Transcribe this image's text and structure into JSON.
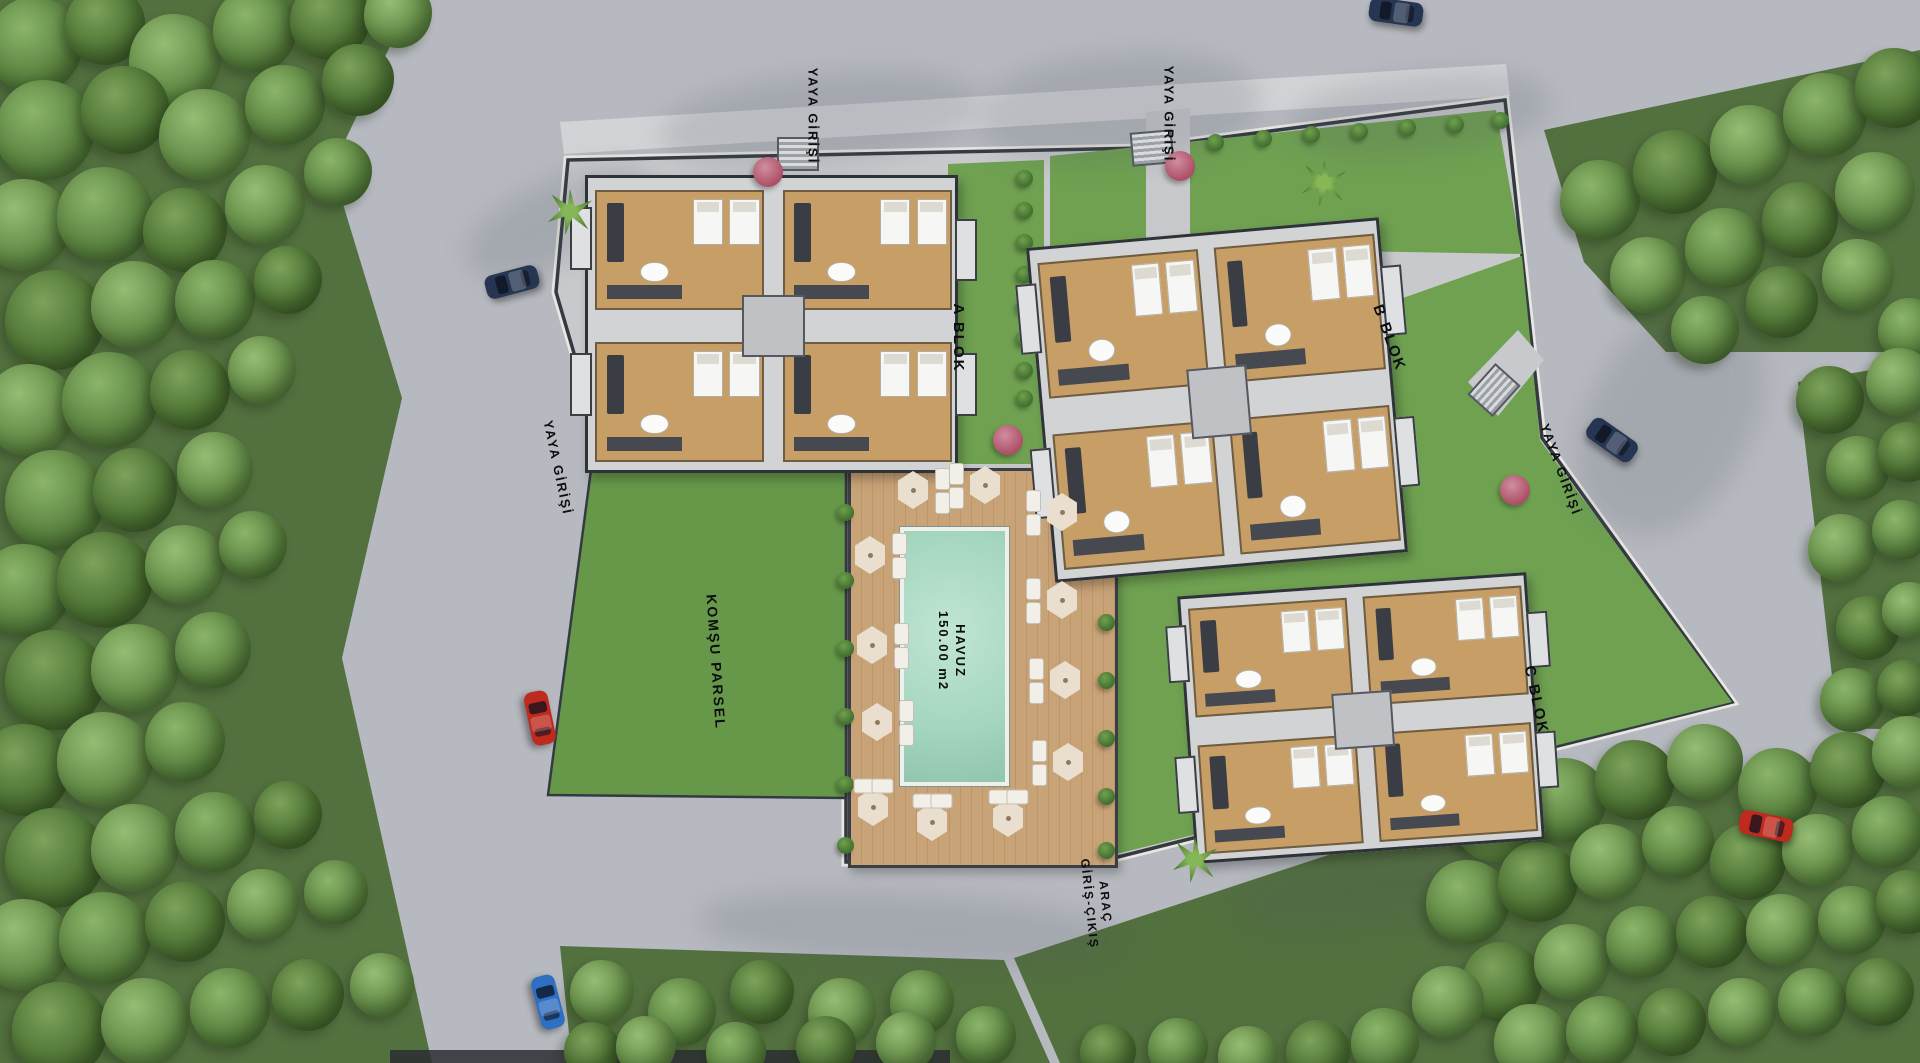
{
  "scene": {
    "width": 1920,
    "height": 1063,
    "type": "residential-site-plan"
  },
  "colors": {
    "road": "#b6b9bf",
    "sidewalk": "#d2d3d6",
    "forest": "#53703f",
    "lawn": "#6fa151",
    "lawn2": "#67984a",
    "paving": "#c8c9cc",
    "boundary": "#343a41",
    "curb": "#e9e7e1",
    "deck": "#c8a377",
    "pool": "#a5d6c0",
    "plate": "#d2d3d5",
    "bborder": "#2e3338",
    "floor": "#c79e66",
    "dark": "#3a3e44",
    "umbrella": "#eadfce",
    "bush": "#3f6b2e",
    "navy": "#263652",
    "red": "#bf2a1e",
    "blue": "#2f6fc2"
  },
  "labels": [
    {
      "id": "yaya-girisi-top-left",
      "text": "YAYA GİRİŞİ",
      "x": 812,
      "y": 116,
      "rot": 90,
      "size": 13
    },
    {
      "id": "yaya-girisi-top-right",
      "text": "YAYA GİRİŞİ",
      "x": 1168,
      "y": 114,
      "rot": 90,
      "size": 13
    },
    {
      "id": "yaya-girisi-west",
      "text": "YAYA GİRİŞİ",
      "x": 557,
      "y": 468,
      "rot": 78,
      "size": 13
    },
    {
      "id": "yaya-girisi-east",
      "text": "YAYA GİRİŞİ",
      "x": 1560,
      "y": 470,
      "rot": 70,
      "size": 13
    },
    {
      "id": "arac-giris-cikis",
      "text": "ARAÇ\nGİRİŞ-ÇIKIŞ",
      "x": 1097,
      "y": 903,
      "rot": 84,
      "size": 12
    },
    {
      "id": "a-blok-label",
      "text": "A BLOK",
      "x": 958,
      "y": 338,
      "rot": 90,
      "size": 15
    },
    {
      "id": "b-blok-label",
      "text": "B BLOK",
      "x": 1389,
      "y": 338,
      "rot": 70,
      "size": 15
    },
    {
      "id": "c-blok-label",
      "text": "C BLOK",
      "x": 1536,
      "y": 700,
      "rot": 78,
      "size": 15
    },
    {
      "id": "komsu-parsel-label",
      "text": "KOMŞU PARSEL",
      "x": 716,
      "y": 662,
      "rot": 86,
      "size": 14
    },
    {
      "id": "havuz-label",
      "text": "HAVUZ\n150.00 m2",
      "x": 951,
      "y": 651,
      "rot": 90,
      "size": 13
    }
  ],
  "buildings": [
    {
      "id": "a-blok",
      "x": 585,
      "y": 175,
      "w": 367,
      "h": 292,
      "rot": 0
    },
    {
      "id": "b-blok",
      "x": 1040,
      "y": 232,
      "w": 348,
      "h": 330,
      "rot": -5
    },
    {
      "id": "c-blok",
      "x": 1186,
      "y": 584,
      "w": 344,
      "h": 262,
      "rot": -4
    }
  ],
  "stairs": [
    {
      "x": 796,
      "y": 152,
      "rot": 0
    },
    {
      "x": 1150,
      "y": 146,
      "rot": -5
    },
    {
      "x": 1492,
      "y": 388,
      "rot": -48
    }
  ],
  "cars": [
    {
      "color": "navy",
      "x": 512,
      "y": 282,
      "rot": -15
    },
    {
      "color": "red",
      "x": 540,
      "y": 718,
      "rot": 78
    },
    {
      "color": "blue",
      "x": 548,
      "y": 1002,
      "rot": 75
    },
    {
      "color": "navy",
      "x": 1396,
      "y": 12,
      "rot": 8
    },
    {
      "color": "navy",
      "x": 1612,
      "y": 440,
      "rot": 35
    },
    {
      "color": "red",
      "x": 1766,
      "y": 826,
      "rot": 12
    }
  ],
  "umbrellas": [
    [
      913,
      490
    ],
    [
      985,
      485
    ],
    [
      1062,
      512
    ],
    [
      870,
      555
    ],
    [
      1062,
      600
    ],
    [
      872,
      645
    ],
    [
      1065,
      680
    ],
    [
      877,
      722
    ],
    [
      1068,
      762
    ],
    [
      873,
      807
    ],
    [
      932,
      822
    ],
    [
      1008,
      818
    ]
  ],
  "red_trees": [
    [
      768,
      172
    ],
    [
      1180,
      166
    ],
    [
      1515,
      490
    ],
    [
      1008,
      440
    ]
  ],
  "palms": [
    [
      570,
      212
    ],
    [
      1324,
      183
    ],
    [
      1195,
      860
    ]
  ],
  "bushes": [
    [
      1024,
      178
    ],
    [
      1024,
      210
    ],
    [
      1024,
      242
    ],
    [
      1024,
      274
    ],
    [
      1024,
      306
    ],
    [
      1024,
      338
    ],
    [
      1024,
      370
    ],
    [
      1024,
      398
    ],
    [
      1106,
      506
    ],
    [
      1106,
      564
    ],
    [
      1106,
      622
    ],
    [
      1106,
      680
    ],
    [
      1106,
      738
    ],
    [
      1106,
      796
    ],
    [
      1106,
      850
    ],
    [
      845,
      512
    ],
    [
      845,
      580
    ],
    [
      845,
      648
    ],
    [
      845,
      716
    ],
    [
      845,
      784
    ],
    [
      845,
      845
    ],
    [
      1215,
      142
    ],
    [
      1263,
      138
    ],
    [
      1311,
      134
    ],
    [
      1359,
      131
    ],
    [
      1407,
      127
    ],
    [
      1455,
      124
    ],
    [
      1500,
      120
    ]
  ],
  "shadow_blobs": [
    [
      660,
      75,
      320,
      90,
      -6
    ],
    [
      980,
      55,
      280,
      110,
      -4
    ],
    [
      1290,
      75,
      260,
      80,
      -6
    ],
    [
      1590,
      300,
      160,
      240,
      28
    ],
    [
      700,
      895,
      420,
      70,
      3
    ],
    [
      1240,
      850,
      300,
      70,
      -8
    ],
    [
      460,
      180,
      200,
      80,
      -25
    ]
  ],
  "forest_trees": [
    [
      35,
      45,
      48
    ],
    [
      105,
      25,
      40
    ],
    [
      175,
      60,
      46
    ],
    [
      255,
      30,
      42
    ],
    [
      330,
      20,
      40
    ],
    [
      398,
      14,
      34
    ],
    [
      45,
      130,
      50
    ],
    [
      125,
      110,
      44
    ],
    [
      205,
      135,
      46
    ],
    [
      285,
      105,
      40
    ],
    [
      358,
      80,
      36
    ],
    [
      25,
      225,
      46
    ],
    [
      105,
      215,
      48
    ],
    [
      185,
      230,
      42
    ],
    [
      265,
      205,
      40
    ],
    [
      338,
      172,
      34
    ],
    [
      55,
      320,
      50
    ],
    [
      135,
      305,
      44
    ],
    [
      215,
      300,
      40
    ],
    [
      288,
      280,
      34
    ],
    [
      30,
      410,
      46
    ],
    [
      110,
      400,
      48
    ],
    [
      190,
      390,
      40
    ],
    [
      262,
      370,
      34
    ],
    [
      55,
      500,
      50
    ],
    [
      135,
      490,
      42
    ],
    [
      215,
      470,
      38
    ],
    [
      25,
      590,
      46
    ],
    [
      105,
      580,
      48
    ],
    [
      185,
      565,
      40
    ],
    [
      253,
      545,
      34
    ],
    [
      55,
      680,
      50
    ],
    [
      135,
      668,
      44
    ],
    [
      213,
      650,
      38
    ],
    [
      25,
      770,
      46
    ],
    [
      105,
      760,
      48
    ],
    [
      185,
      742,
      40
    ],
    [
      55,
      858,
      50
    ],
    [
      135,
      848,
      44
    ],
    [
      215,
      832,
      40
    ],
    [
      288,
      815,
      34
    ],
    [
      25,
      945,
      46
    ],
    [
      105,
      938,
      46
    ],
    [
      185,
      922,
      40
    ],
    [
      263,
      905,
      36
    ],
    [
      336,
      892,
      32
    ],
    [
      60,
      1030,
      48
    ],
    [
      145,
      1022,
      44
    ],
    [
      230,
      1008,
      40
    ],
    [
      308,
      995,
      36
    ],
    [
      382,
      985,
      32
    ],
    [
      1600,
      200,
      40
    ],
    [
      1675,
      172,
      42
    ],
    [
      1750,
      145,
      40
    ],
    [
      1825,
      115,
      42
    ],
    [
      1895,
      88,
      40
    ],
    [
      1648,
      275,
      38
    ],
    [
      1725,
      248,
      40
    ],
    [
      1800,
      220,
      38
    ],
    [
      1875,
      192,
      40
    ],
    [
      1705,
      330,
      34
    ],
    [
      1782,
      302,
      36
    ],
    [
      1858,
      275,
      36
    ],
    [
      1910,
      330,
      32
    ],
    [
      1830,
      400,
      34
    ],
    [
      1900,
      382,
      34
    ],
    [
      1858,
      468,
      32
    ],
    [
      1908,
      452,
      30
    ],
    [
      1842,
      548,
      34
    ],
    [
      1902,
      530,
      30
    ],
    [
      1868,
      628,
      32
    ],
    [
      1910,
      610,
      28
    ],
    [
      1852,
      700,
      32
    ],
    [
      1905,
      688,
      28
    ],
    [
      1495,
      822,
      40
    ],
    [
      1565,
      800,
      42
    ],
    [
      1635,
      780,
      40
    ],
    [
      1705,
      762,
      38
    ],
    [
      1778,
      788,
      40
    ],
    [
      1848,
      770,
      38
    ],
    [
      1908,
      752,
      36
    ],
    [
      1468,
      902,
      42
    ],
    [
      1538,
      882,
      40
    ],
    [
      1608,
      862,
      38
    ],
    [
      1678,
      842,
      36
    ],
    [
      1748,
      862,
      38
    ],
    [
      1818,
      850,
      36
    ],
    [
      1888,
      832,
      36
    ],
    [
      1502,
      982,
      40
    ],
    [
      1572,
      962,
      38
    ],
    [
      1642,
      942,
      36
    ],
    [
      1712,
      932,
      36
    ],
    [
      1782,
      930,
      36
    ],
    [
      1852,
      920,
      34
    ],
    [
      1908,
      902,
      32
    ],
    [
      1532,
      1042,
      38
    ],
    [
      1602,
      1032,
      36
    ],
    [
      1672,
      1022,
      34
    ],
    [
      1742,
      1012,
      34
    ],
    [
      1812,
      1002,
      34
    ],
    [
      1880,
      992,
      34
    ],
    [
      1448,
      1002,
      36
    ],
    [
      1385,
      1042,
      34
    ],
    [
      1318,
      1052,
      32
    ],
    [
      1248,
      1056,
      30
    ],
    [
      1178,
      1048,
      30
    ],
    [
      1108,
      1052,
      28
    ],
    [
      602,
      992,
      32
    ],
    [
      682,
      1012,
      34
    ],
    [
      762,
      992,
      32
    ],
    [
      842,
      1012,
      34
    ],
    [
      922,
      1002,
      32
    ],
    [
      592,
      1050,
      28
    ],
    [
      646,
      1046,
      30
    ],
    [
      736,
      1052,
      30
    ],
    [
      826,
      1046,
      30
    ],
    [
      906,
      1042,
      30
    ],
    [
      986,
      1036,
      30
    ]
  ]
}
